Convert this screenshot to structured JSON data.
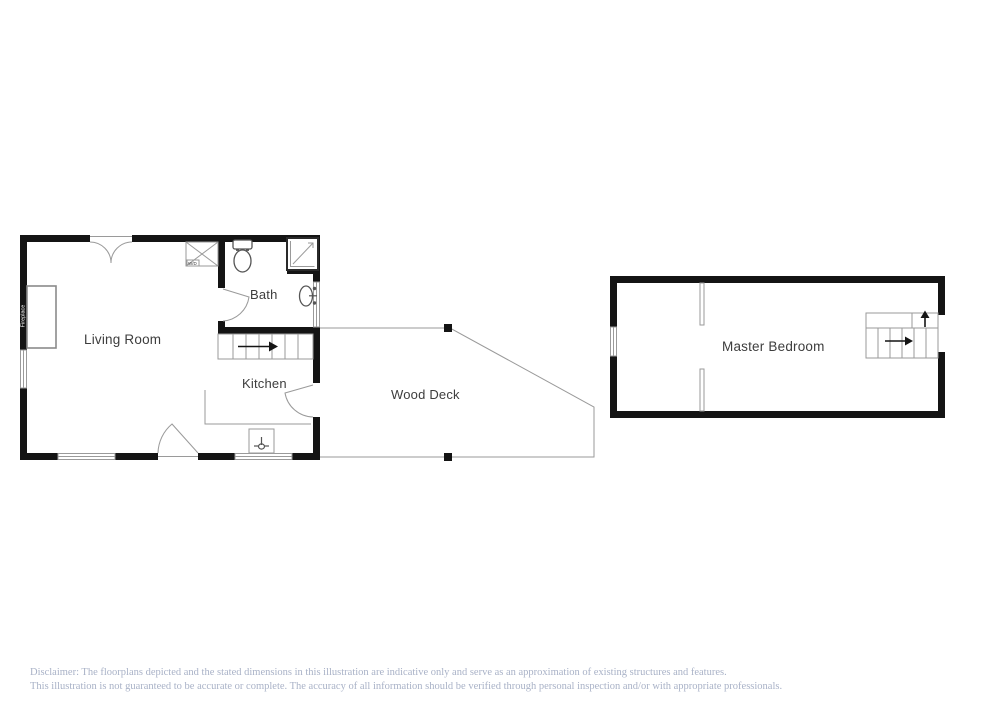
{
  "floorplan": {
    "rooms": {
      "living_room": "Living Room",
      "bath": "Bath",
      "kitchen": "Kitchen",
      "wood_deck": "Wood Deck",
      "master_bedroom": "Master Bedroom"
    },
    "fixtures": {
      "fireplace": "Fireplace",
      "closet_label": "W/D"
    }
  },
  "disclaimer": {
    "line1": "Disclaimer: The floorplans depicted and the stated dimensions in this illustration are indicative only and serve as an approximation of existing structures and features.",
    "line2": "This illustration is not guaranteed to be accurate or complete. The accuracy of all information should be verified through personal inspection and/or with appropriate professionals."
  },
  "colors": {
    "wall": "#141414",
    "thin_line": "#9a9a9a",
    "fixture_line": "#555555",
    "label_text": "#3d3d3d",
    "disclaimer_text": "#a9b2c7",
    "background": "#ffffff"
  }
}
